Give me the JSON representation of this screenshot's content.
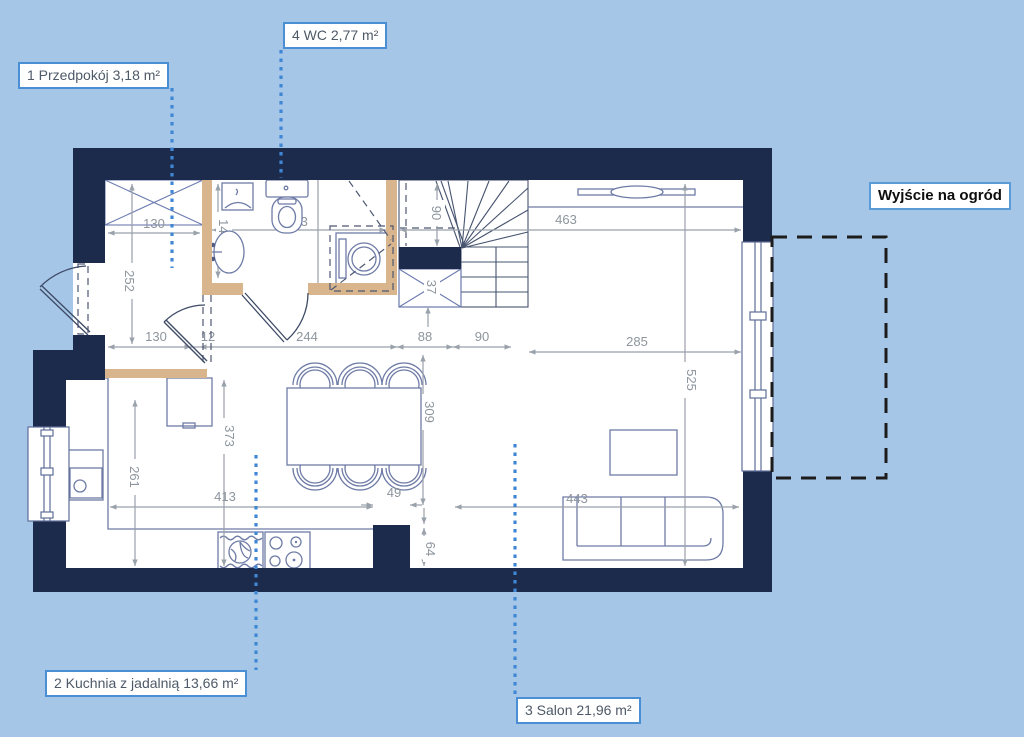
{
  "colors": {
    "background": "#a6c6e8",
    "wall": "#1c2b4c",
    "partition": "#d9b58d",
    "accent": "#3f87d4",
    "label_border": "#4a8fd4",
    "dimension": "#99a1aa",
    "furniture": "#6e7ba6"
  },
  "room_labels": {
    "przedpokoj": "1 Przedpokój 3,18 m²",
    "wc": "4 WC 2,77 m²",
    "kuchnia": "2 Kuchnia z jadalnią 13,66 m²",
    "salon": "3 Salon 21,96 m²"
  },
  "exit_label": "Wyjście na ogród",
  "dimensions_cm": {
    "closet_width": "130",
    "hall_depth": "252",
    "wc_depth": "140",
    "wc_length": "233",
    "stair_width": "90",
    "salon_top": "463",
    "hall_width": "130",
    "wall_gap": "12",
    "kitchen_top": "244",
    "stair_seg_a": "88",
    "stair_seg_b": "90",
    "salon_right": "285",
    "salon_depth": "525",
    "kitchen_depth": "373",
    "kitchen_left": "261",
    "dining_width": "309",
    "kitchen_bottom": "413",
    "stub_width": "49",
    "sofa_span": "443",
    "stub_height": "64",
    "stair_stub": "37"
  }
}
